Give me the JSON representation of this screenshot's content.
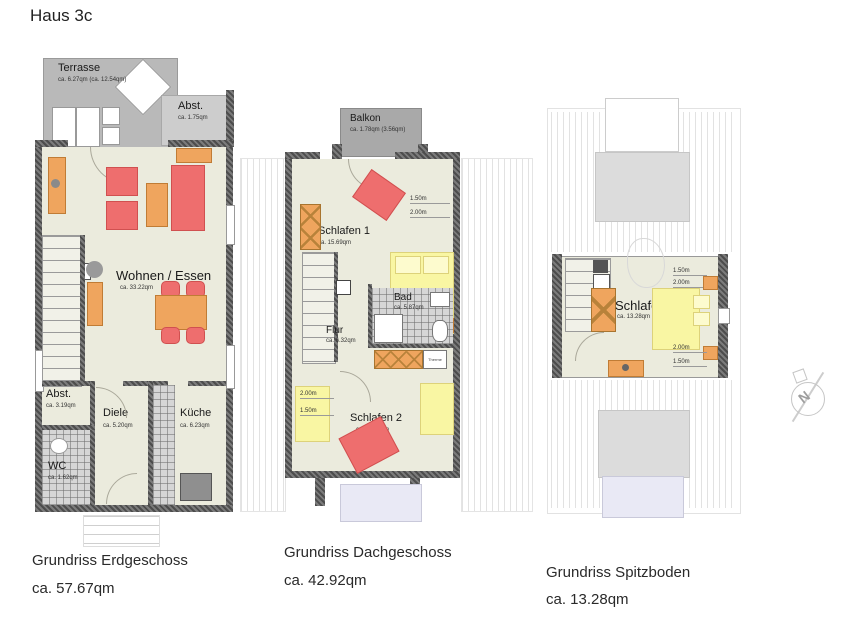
{
  "title": "Haus 3c",
  "compass_letter": "N",
  "colors": {
    "room_fill": "#ebebdd",
    "wall": "#5a5a5a",
    "terrace_gray": "#b9b9b9",
    "balcony_gray": "#a9a9a9",
    "furniture_red": "#ee6e6e",
    "furniture_orange": "#efa55e",
    "bed_yellow": "#f9f6a3",
    "tile_gray": "#d6d6d6",
    "dormer_lavender": "#e9e9f5"
  },
  "plans": {
    "erdgeschoss": {
      "caption": "Grundriss Erdgeschoss",
      "total_area": "ca. 57.67qm",
      "rooms": {
        "terrasse": {
          "name": "Terrasse",
          "area": "ca. 6.27qm (ca. 12.54qm)"
        },
        "abstellraum_oben": {
          "name": "Abst.",
          "area": "ca. 1.75qm"
        },
        "wohnen_essen": {
          "name": "Wohnen / Essen",
          "area": "ca. 33.22qm"
        },
        "abstellraum": {
          "name": "Abst.",
          "area": "ca. 3.19qm"
        },
        "wc": {
          "name": "WC",
          "area": "ca. 1.62qm"
        },
        "diele": {
          "name": "Diele",
          "area": "ca. 5.20qm"
        },
        "kueche": {
          "name": "Küche",
          "area": "ca. 6.23qm"
        }
      }
    },
    "dachgeschoss": {
      "caption": "Grundriss Dachgeschoss",
      "total_area": "ca. 42.92qm",
      "rooms": {
        "balkon": {
          "name": "Balkon",
          "area": "ca. 1.78qm (3.56qm)"
        },
        "schlafen1": {
          "name": "Schlafen 1",
          "area": "ca. 15.69qm",
          "dims": [
            "1.50m",
            "2.00m"
          ]
        },
        "bad": {
          "name": "Bad",
          "area": "ca. 5.87qm"
        },
        "flur": {
          "name": "Flur",
          "area": "ca. 6.32qm"
        },
        "schlafen2": {
          "name": "Schlafen 2",
          "area": "ca. 10.86qm",
          "dims": [
            "2.00m",
            "1.50m"
          ]
        },
        "therme_label": "Therme"
      }
    },
    "spitzboden": {
      "caption": "Grundriss Spitzboden",
      "total_area": "ca. 13.28qm",
      "rooms": {
        "schlafen": {
          "name": "Schlafen",
          "area": "ca. 13.28qm",
          "dims_top": [
            "1.50m",
            "2.00m"
          ],
          "dims_bottom": [
            "2.00m",
            "1.50m"
          ]
        }
      }
    }
  }
}
